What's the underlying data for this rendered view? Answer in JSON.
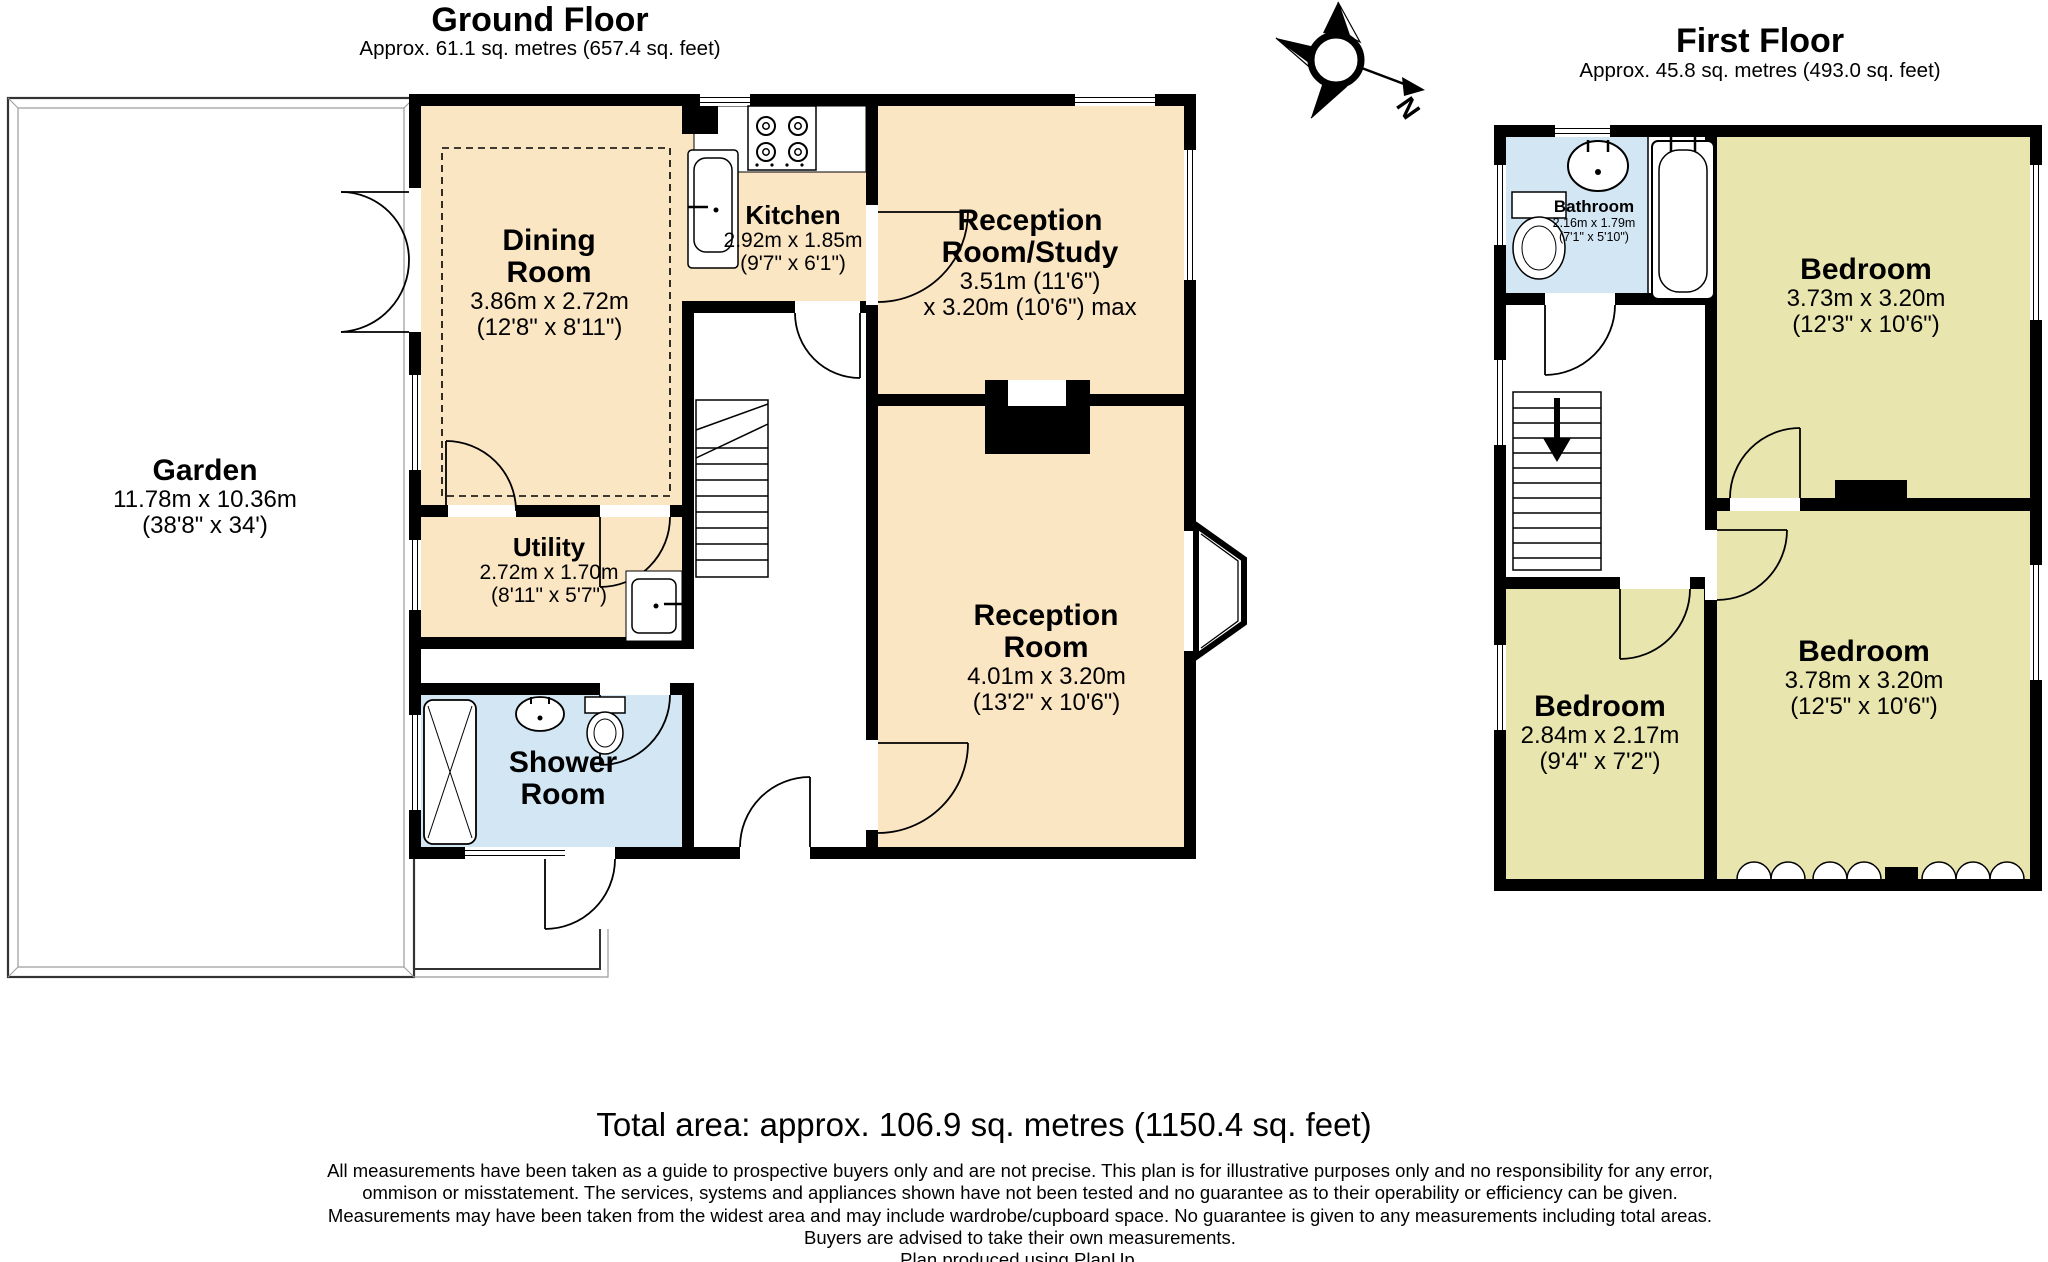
{
  "compass": {
    "label": "N"
  },
  "ground_floor": {
    "title": "Ground Floor",
    "subtitle": "Approx. 61.1 sq. metres (657.4 sq. feet)",
    "rooms": {
      "garden": {
        "name": "Garden",
        "dims_m": "11.78m x 10.36m",
        "dims_ft": "(38'8\" x 34')"
      },
      "dining_room": {
        "name": "Dining Room",
        "dims_m": "3.86m x 2.72m",
        "dims_ft": "(12'8\" x 8'11\")"
      },
      "kitchen": {
        "name": "Kitchen",
        "dims_m": "2.92m x 1.85m",
        "dims_ft": "(9'7\" x 6'1\")"
      },
      "reception_study": {
        "name": "Reception Room/Study",
        "dims_m": "3.51m (11'6\")",
        "dims_ft": "x 3.20m (10'6\") max"
      },
      "utility": {
        "name": "Utility",
        "dims_m": "2.72m x 1.70m",
        "dims_ft": "(8'11\" x 5'7\")"
      },
      "shower_room": {
        "name": "Shower Room",
        "dims_m": "",
        "dims_ft": ""
      },
      "reception_room": {
        "name": "Reception Room",
        "dims_m": "4.01m x 3.20m",
        "dims_ft": "(13'2\" x 10'6\")"
      }
    }
  },
  "first_floor": {
    "title": "First Floor",
    "subtitle": "Approx. 45.8 sq. metres (493.0 sq. feet)",
    "rooms": {
      "bathroom": {
        "name": "Bathroom",
        "dims_m": "2.16m x 1.79m",
        "dims_ft": "(7'1\" x 5'10\")"
      },
      "bedroom_ne": {
        "name": "Bedroom",
        "dims_m": "3.73m x 3.20m",
        "dims_ft": "(12'3\" x 10'6\")"
      },
      "bedroom_se": {
        "name": "Bedroom",
        "dims_m": "3.78m x 3.20m",
        "dims_ft": "(12'5\" x 10'6\")"
      },
      "bedroom_sw": {
        "name": "Bedroom",
        "dims_m": "2.84m x 2.17m",
        "dims_ft": "(9'4\" x 7'2\")"
      }
    }
  },
  "footer": {
    "total_area": "Total area: approx. 106.9 sq. metres (1150.4 sq. feet)",
    "disclaimer": [
      "All measurements have been taken as a guide to prospective buyers only and are not precise. This plan is for illustrative purposes only and no responsibility for any error,",
      "ommison or misstatement. The services, systems and appliances shown have not been tested and no guarantee as to their operability or efficiency can be given.",
      "Measurements may have been taken from the widest area and may include wardrobe/cupboard space. No guarantee is given to any measurements including total areas.",
      "Buyers are advised to take their own measurements.",
      "Plan produced using PlanUp."
    ]
  },
  "colors": {
    "room_cream": "#fbe6c4",
    "room_blue": "#d2e6f4",
    "room_khaki": "#e8e5ae",
    "wall": "#000000"
  }
}
